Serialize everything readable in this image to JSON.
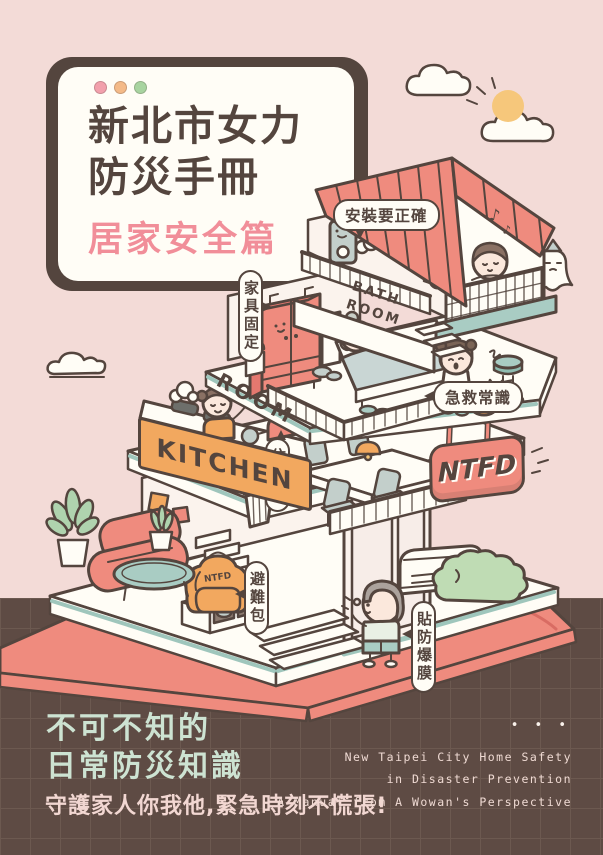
{
  "palette": {
    "background_pink": "#F3DBD7",
    "footer_brown": "#5E4B44",
    "outline_brown": "#54453E",
    "roof_red": "#EF8B7E",
    "accent_teal": "#A9CCC3",
    "accent_orange": "#F2A85F",
    "title_pink": "#F18E99",
    "headline_mint": "#CDE3D2",
    "tagline_pink": "#F2D7D2"
  },
  "title_card": {
    "title_line1": "新北市女力",
    "title_line2": "防災手冊",
    "subtitle": "居家安全篇",
    "dot_styles": [
      "background:#F2A0AC",
      "background:#F4BA88",
      "background:#A8D4A0"
    ]
  },
  "callouts": {
    "install": "安裝要正確",
    "furniture": "家具固定",
    "first_aid": "急救常識",
    "alarm": "住警器",
    "go_bag": "避難包",
    "film": "貼防爆膜"
  },
  "signs": {
    "bathroom": "BATH\nROOM",
    "room": "ROOM",
    "kitchen": "KITCHEN",
    "ntfd": "NTFD",
    "backpack": "NTFD"
  },
  "icons": {
    "music_note": "♪",
    "ellipsis_dots": "• • •"
  },
  "footer": {
    "headline_line1": "不可不知的",
    "headline_line2": "日常防災知識",
    "tagline": "守護家人你我他,緊急時刻不慌張!",
    "en_line1": "New Taipei City Home Safety",
    "en_line2": "in Disaster Prevention",
    "en_line3": "A Manual from A Wowan's Perspective"
  }
}
